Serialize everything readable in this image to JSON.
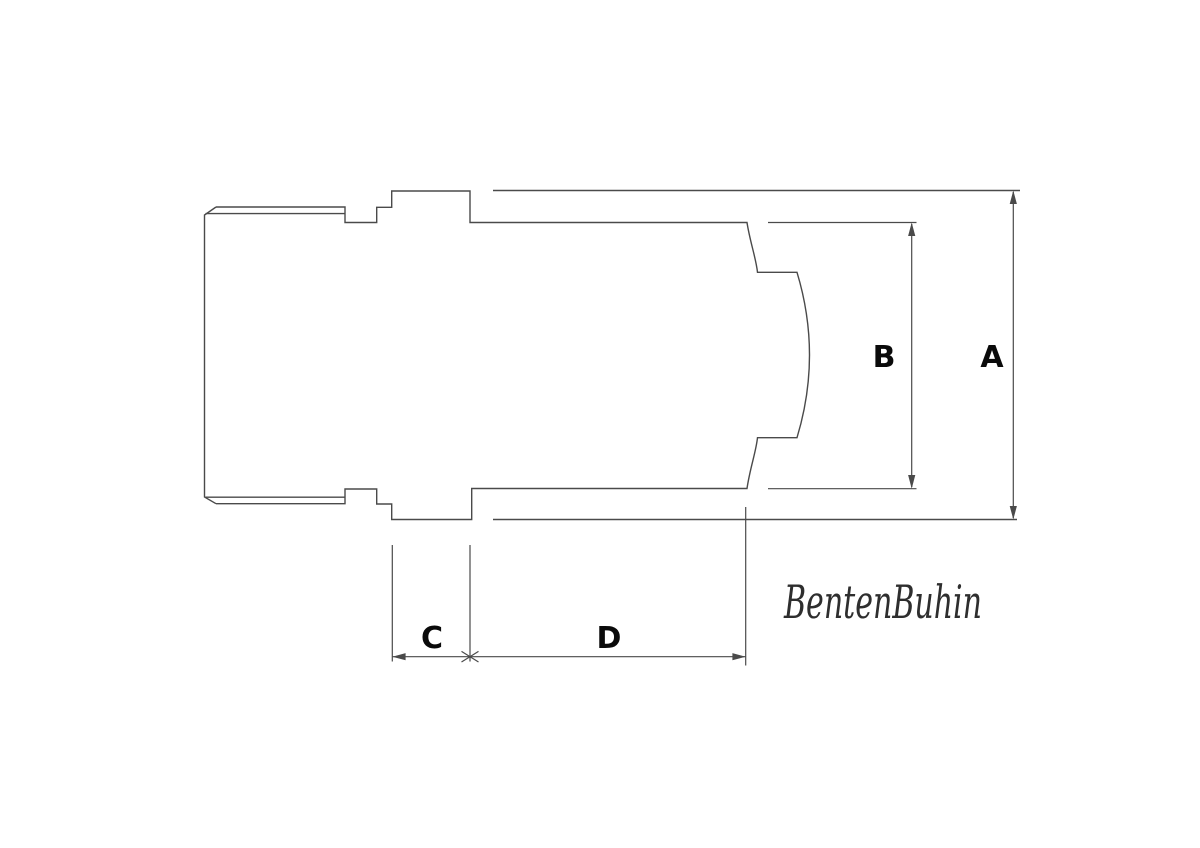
{
  "page": {
    "background": "#ffffff"
  },
  "drawing": {
    "type": "technical-dimension-diagram",
    "line_color": "#4a4a4a",
    "label_color": "#0a0a0a",
    "signature_color": "#2e2e2e",
    "labels": {
      "a": "A",
      "b": "B",
      "c": "C",
      "d": "D"
    },
    "signature": "BentenBuhin"
  }
}
